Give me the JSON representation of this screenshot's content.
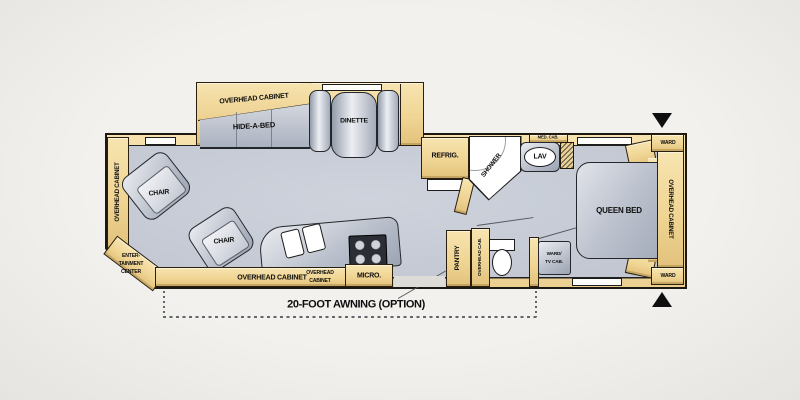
{
  "colors": {
    "cabinet_tan": "#f0d594",
    "cabinet_shadow": "#d9b878",
    "floor_gray": "#c9cdd6",
    "furniture_gray": "#b9bfca",
    "outline_black": "#1c1c1c",
    "background": "#efeeeb",
    "fixture_white": "#ffffff"
  },
  "floorplan": {
    "front_living": {
      "overhead_cabinet_left": "OVERHEAD CABINET",
      "entertainment_center": [
        "ENTER-",
        "TAINMENT",
        "CENTER"
      ],
      "chair_front": "CHAIR",
      "chair_rear": "CHAIR",
      "overhead_cabinet_slide": "OVERHEAD CABINET",
      "hide_a_bed": "HIDE-A-BED",
      "dinette": "DINETTE"
    },
    "kitchen": {
      "overhead_cabinet_bottom": "OVERHEAD CABINET",
      "overhead_cabinet_small": [
        "OVERHEAD",
        "CABINET"
      ],
      "micro": "MICRO.",
      "refrig": "REFRIG.",
      "pantry": "PANTRY"
    },
    "bath": {
      "shower": "SHOWER",
      "med_cab": "MED. CAB.",
      "lav": "LAV",
      "overhead_cab": "OVERHEAD CAB."
    },
    "bedroom": {
      "queen_bed": "QUEEN BED",
      "ward_top": "WARD",
      "ward_bottom": "WARD",
      "overhead_cabinet_right": "OVERHEAD CABINET",
      "ward_tv_cab": [
        "WARD/",
        "TV CAB."
      ]
    },
    "awning_label": "20-FOOT AWNING (OPTION)"
  }
}
